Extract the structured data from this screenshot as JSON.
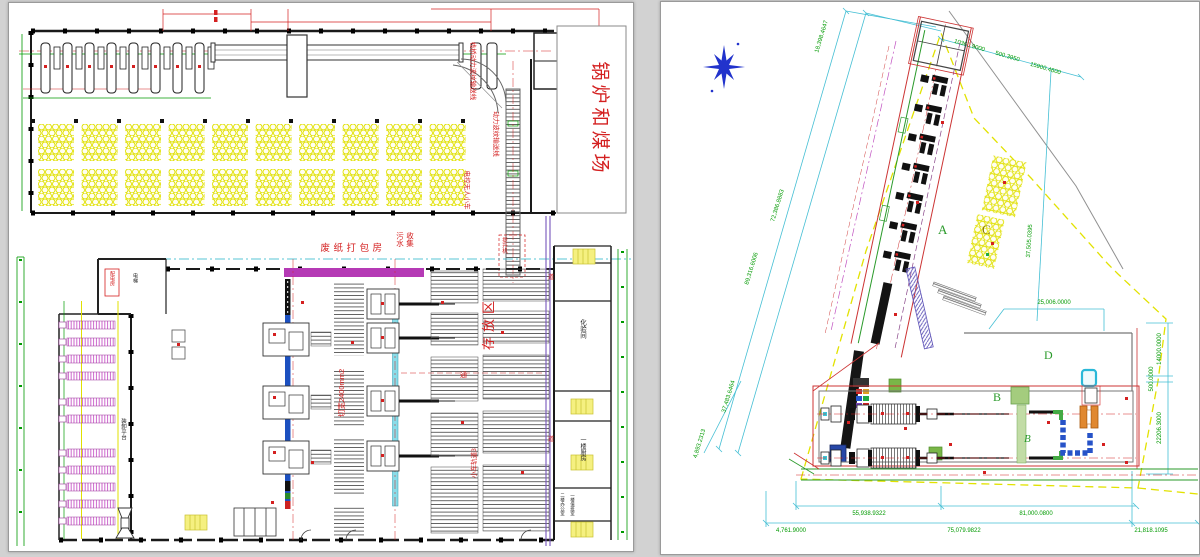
{
  "window": {
    "background": "#d2d2d2",
    "sheet_background": "#ffffff"
  },
  "left_drawing": {
    "coal_yard_label": "锅炉和煤场",
    "annotations": {
      "trestle_conveyor": "栈桥动力波纹输送线",
      "power_conveyor": "动力波纹输送线",
      "agv_cart": "电控无人小车",
      "baling_room": "废纸打包房",
      "sewage_col1": "污水",
      "sewage_col2": "收集",
      "hoist": "提升机",
      "storage_area": "存放区",
      "cut_width": "切宽2400mm2",
      "cart_track": "小车轨道3",
      "power_room": "配电房",
      "elevator": "电梯",
      "loading_platform": "装卸平台",
      "lab_room": "化验间",
      "kitchen": "一楼厨房",
      "office_2f": "二楼办公室",
      "duty_room": "一楼值班室",
      "aisle_char_1": "道",
      "aisle_char_2": "道",
      "aisle_char_3": "通"
    }
  },
  "right_drawing": {
    "area_labels": {
      "a": "A",
      "b": "B",
      "b_italic": "B",
      "c": "C",
      "d": "D"
    },
    "dimensions": {
      "diag_1": "18,398.4647",
      "diag_2": "72,386.8883",
      "diag_3": "89,316.6006",
      "diag_4": "37,483.6464",
      "diag_5": "4,893.2313",
      "top_1": "10360.9000",
      "top_2": "500.3950",
      "top_3": "15900.4600",
      "mid_1": "37,505.0395",
      "mid_2": "25,006.0000",
      "right_1": "14000.0000",
      "right_2": "500.0000",
      "right_3": "22206.3000",
      "bottom_1": "4,761.9000",
      "bottom_2": "55,938.9322",
      "bottom_3": "75,079.9822",
      "bottom_4": "81,000.0800",
      "bottom_5": "21,818.1095"
    }
  },
  "colors": {
    "cad_red": "#d42020",
    "cad_green": "#009a00",
    "cad_cyan": "#45bfd4",
    "cad_yellow": "#e2e200",
    "cad_magenta": "#b53ab5",
    "conveyor_blue": "#1c50c0",
    "conveyor_cyan": "#8adce8",
    "machine_pink": "#cc66cc",
    "north_blue": "#2233cc"
  }
}
